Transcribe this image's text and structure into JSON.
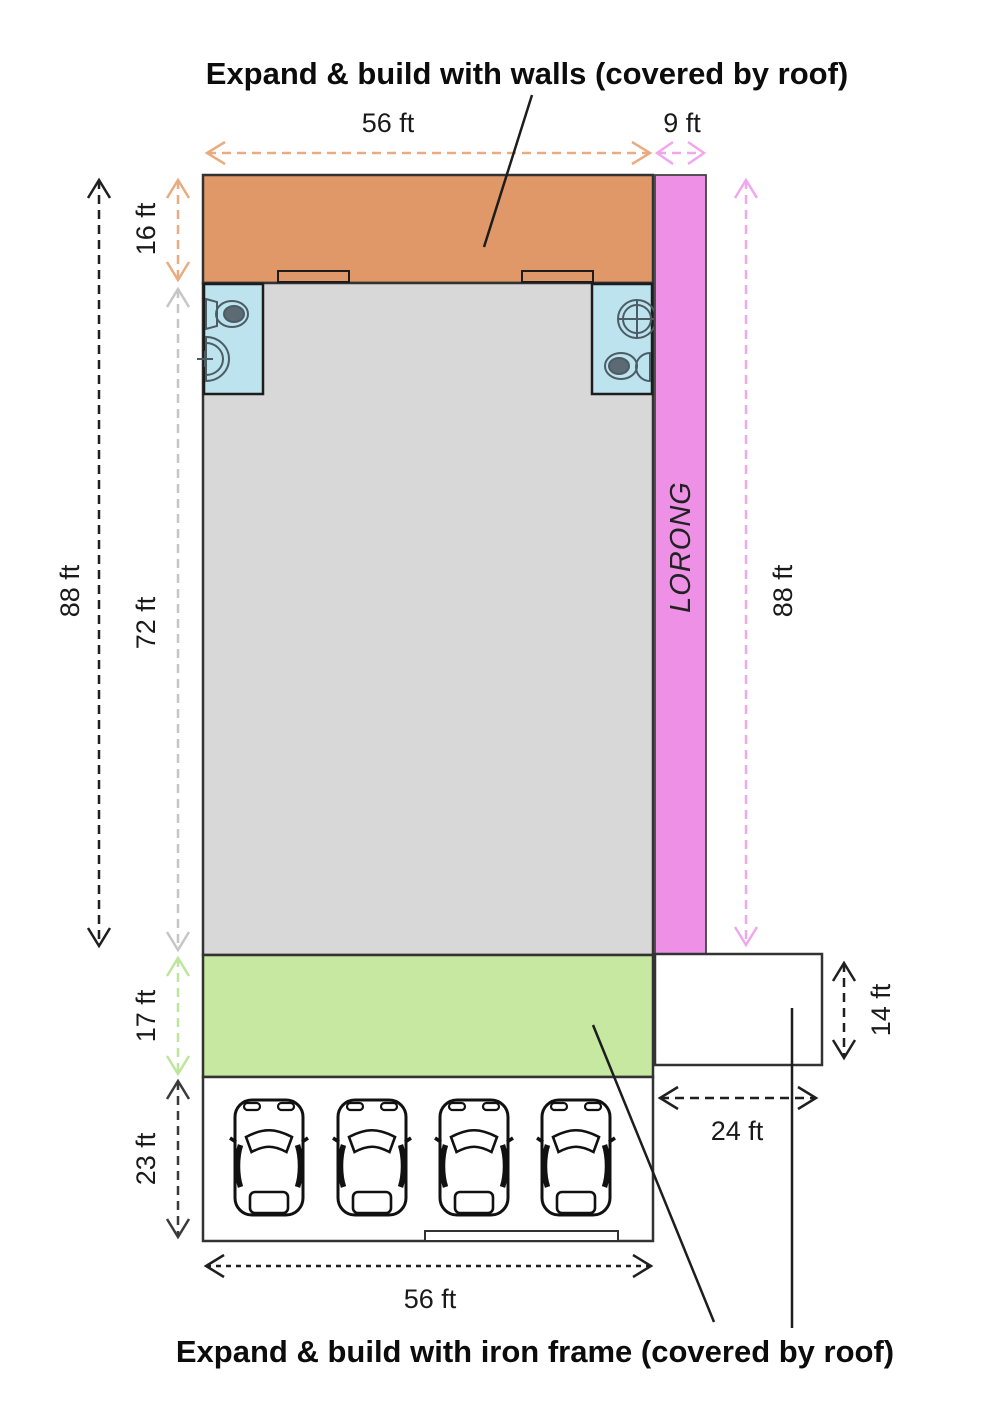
{
  "titles": {
    "top": "Expand & build with walls (covered by roof)",
    "bottom": "Expand & build with iron frame (covered by roof)"
  },
  "road_label": "LORONG",
  "dimensions": {
    "top_width": "56 ft",
    "lorong_width": "9 ft",
    "total_height_left": "88 ft",
    "walls_section_height": "16 ft",
    "main_building_height": "72 ft",
    "total_height_right": "88 ft",
    "iron_frame_section_height": "17 ft",
    "parking_depth": "23 ft",
    "annex_height": "14 ft",
    "annex_width": "24 ft",
    "bottom_width": "56 ft"
  },
  "colors": {
    "walls_extension": "#E09868",
    "main_building": "#D8D8D8",
    "toilet_room": "#BDE3EE",
    "lorong_road": "#EE90E6",
    "iron_frame_extension": "#C6E8A1",
    "arrow_orange": "#E9AC80",
    "arrow_pink": "#F0A8EC",
    "arrow_gray": "#C6C6C6",
    "arrow_green": "#BEE59C",
    "arrow_black": "#1F1F1F",
    "arrow_dark": "#3A3A3A"
  }
}
